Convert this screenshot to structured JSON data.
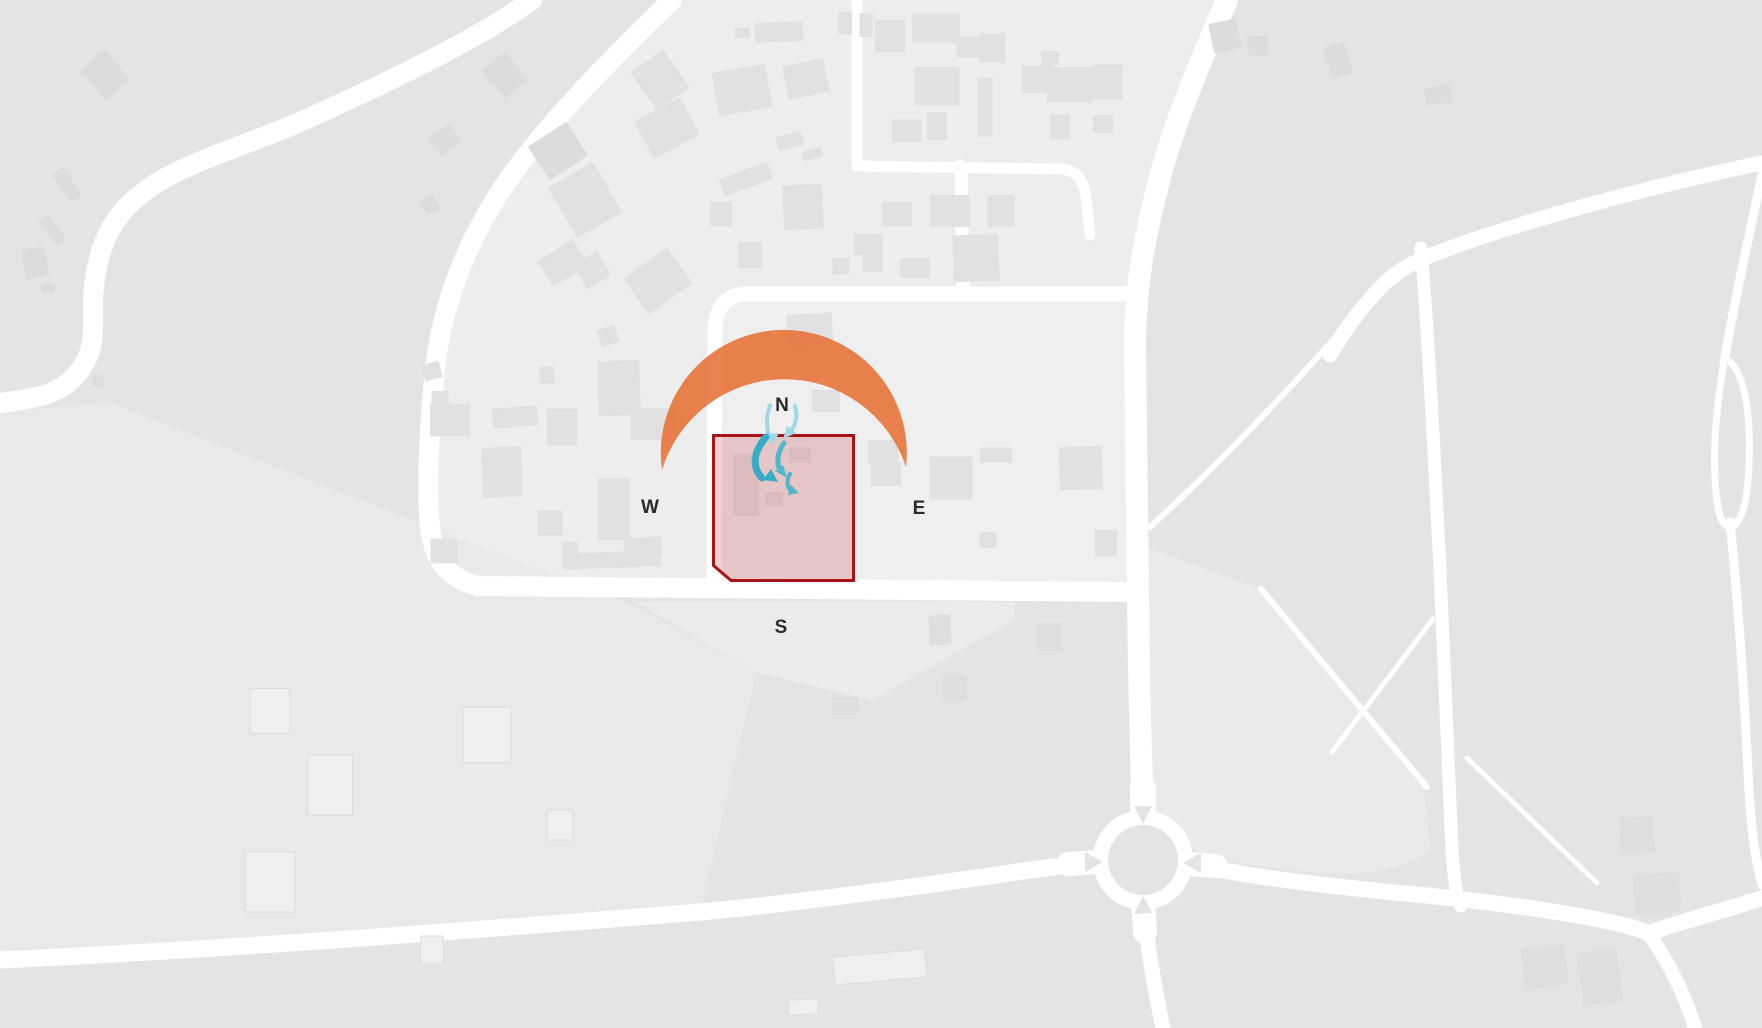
{
  "meta": {
    "view": "site-analysis-map",
    "canvas": {
      "w": 1762,
      "h": 1028
    }
  },
  "overlay": {
    "compass": {
      "n": "N",
      "w": "W",
      "e": "E",
      "s": "S"
    },
    "compass_positions": {
      "n": {
        "x": 782,
        "y": 411
      },
      "w": {
        "x": 650,
        "y": 513
      },
      "e": {
        "x": 919,
        "y": 514
      },
      "s": {
        "x": 781,
        "y": 633
      }
    },
    "compass_style": {
      "size": 19,
      "color": "#2a2a2a"
    },
    "site_boundary": {
      "points": "713.5,435.5 853.5,435.5 853.5,580.5 731,580.5 713.5,565.5",
      "fill": "rgba(205,100,100,0.30)",
      "stroke": "#a91313",
      "stroke_width": 3
    },
    "sun_path": {
      "path": "M 662,470 A 123,123 0 1 1 906,467 A 128,128 0 0 0 662,470 Z",
      "opacity": 0.92,
      "gradient": {
        "y1": 450,
        "y2": 618,
        "stops": [
          {
            "off": "0%",
            "color": "#e8763e"
          },
          {
            "off": "45%",
            "color": "#f0a55c"
          },
          {
            "off": "100%",
            "color": "#f8d977"
          }
        ]
      }
    },
    "wind_arrows": [
      {
        "path": "M 770,405 C 766,417 766,428 770,438",
        "w": 4,
        "color": "#9fd9e6",
        "head": "765,434 779,433 772,445"
      },
      {
        "path": "M 795,406 C 798,416 796,426 789,433",
        "w": 4,
        "color": "#9fd9e6",
        "head": "787,426 796,433 783,439"
      },
      {
        "path": "M 766,437 C 754,451 751,466 762,478",
        "w": 7,
        "color": "#38abc4",
        "head": "778,482 771,469 763,480"
      },
      {
        "path": "M 784,443 C 777,453 776,464 781,471",
        "w": 5,
        "color": "#4fb6cb",
        "head": "787,478 783,465 775,471"
      },
      {
        "path": "M 790,474 C 786,481 787,488 792,492",
        "w": 4,
        "color": "#4fb6cb",
        "head": "799,493 791,485 788,495"
      }
    ]
  },
  "map": {
    "colors": {
      "base": "#e4e4e4",
      "road": "#ffffff",
      "building_n": "#e1e1e1",
      "building_d": "#dcdcdc",
      "building_s": "#dedede",
      "building_e": "#dedede",
      "building_f": "#efefef",
      "building_f_stroke": "#dcdcdc",
      "island": "#e4e4e4"
    },
    "regions": [
      {
        "name": "district-upper",
        "fill": "#ededed",
        "d": "M 672,0 L 1227,0 C 1200,62 1172,128 1158,185 C 1144,240 1136,283 1135,340 L 1138,592 L 478,586 C 441,577 431,552 429,515 C 427,470 430,415 436,360 C 444,305 462,252 498,195 C 540,130 610,60 672,0 Z"
      },
      {
        "name": "inner-block",
        "fill": "#efefef",
        "d": "M 722,302 L 1128,302 L 1128,586 L 722,586 Z"
      },
      {
        "name": "parcel-south-triangle",
        "fill": "#ebebeb",
        "d": "M 636,602 L 1014,602 L 1014,620 L 872,700 L 754,672 Z"
      },
      {
        "name": "parcel-lower-left",
        "fill": "#e9e9e9",
        "d": "M 0,413 L 108,402 L 640,608 L 756,674 L 700,913 C 500,929 250,949 0,961 Z"
      },
      {
        "name": "field-east",
        "fill": "#eaeaea",
        "d": "M 1152,815 L 1148,548 L 1258,588 L 1424,786 L 1430,850 C 1380,888 1300,872 1205,858 Z"
      }
    ],
    "roads": [
      {
        "name": "rd-sw-curve",
        "w": 20,
        "d": "M 532,0 C 470,45 360,95 300,122 C 240,148 175,165 140,195 C 105,222 95,260 93,300 L 93,330 C 93,360 75,385 45,395 C 25,400 10,402 0,403"
      },
      {
        "name": "rd-arc-and-south",
        "w": 20,
        "d": "M 672,0 C 610,60 540,130 498,195 C 462,252 444,305 436,360 C 430,415 427,470 429,515 C 431,552 441,577 478,586 L 1132,592"
      },
      {
        "name": "rd-east-curve",
        "w": 22,
        "d": "M 1227,0 C 1200,62 1172,128 1158,185 C 1144,240 1136,283 1135,340 L 1138,600 C 1139,680 1141,760 1143,818"
      },
      {
        "name": "rd-ne-diagonal",
        "w": 15,
        "d": "M 1762,163 C 1650,186 1520,222 1442,251 C 1415,261 1398,270 1383,285 C 1360,308 1345,330 1330,355"
      },
      {
        "name": "rd-ne-branch",
        "w": 13,
        "d": "M 1421,248 C 1428,330 1434,450 1440,570 C 1444,660 1448,760 1452,850 C 1454,878 1456,895 1461,906"
      },
      {
        "name": "rd-bottom-left",
        "w": 17,
        "d": "M 0,960 C 250,948 500,928 700,912 C 800,903 950,882 1030,870 C 1060,866 1082,863 1096,862"
      },
      {
        "name": "rd-rb-east",
        "w": 16,
        "d": "M 1190,864 C 1246,876 1310,884 1400,893 C 1490,901 1615,918 1648,933 C 1700,916 1740,906 1762,898"
      },
      {
        "name": "rd-se-branch",
        "w": 14,
        "d": "M 1648,933 C 1668,960 1685,995 1695,1028"
      },
      {
        "name": "rd-rb-south",
        "w": 15,
        "d": "M 1143,902 C 1147,945 1155,990 1163,1028"
      },
      {
        "name": "rd-inner-loop",
        "w": 15,
        "d": "M 1128,294 L 748,294 C 726,295 716,306 715,330 L 714,588"
      },
      {
        "name": "rd-inner-vertical",
        "w": 13,
        "d": "M 963,295 L 961,166"
      },
      {
        "name": "rd-north-tee",
        "w": 11,
        "d": "M 857,0 L 857,162 M 857,166 L 1062,169 C 1077,171 1083,180 1086,196 L 1090,235"
      },
      {
        "name": "rd-right-lens",
        "w": 7,
        "d": "M 1724,362 C 1714,420 1712,470 1718,508 C 1723,532 1735,534 1743,510 C 1750,488 1752,430 1745,395 C 1740,372 1730,356 1724,362"
      },
      {
        "name": "rd-right-stem",
        "w": 9,
        "d": "M 1730,522 C 1738,600 1744,690 1748,770 C 1750,820 1755,860 1762,885"
      },
      {
        "name": "rd-right-top",
        "w": 9,
        "d": "M 1762,175 C 1748,240 1735,300 1724,362"
      },
      {
        "name": "footpath-1",
        "w": 6,
        "d": "M 1378,288 C 1330,345 1245,440 1150,527"
      },
      {
        "name": "footpath-2",
        "w": 6,
        "d": "M 1261,589 L 1427,787"
      },
      {
        "name": "footpath-3",
        "w": 5,
        "d": "M 1433,619 L 1332,752"
      },
      {
        "name": "footpath-4",
        "w": 5,
        "d": "M 1467,758 L 1597,883"
      },
      {
        "name": "rb-stub-n",
        "w": 26,
        "d": "M 1143,822 L 1143,788"
      },
      {
        "name": "rb-stub-w",
        "w": 24,
        "d": "M 1098,862 L 1068,864"
      },
      {
        "name": "rb-stub-s",
        "w": 24,
        "d": "M 1143,898 L 1145,932"
      },
      {
        "name": "rb-stub-e",
        "w": 24,
        "d": "M 1188,864 L 1216,866"
      }
    ],
    "roundabout": {
      "cx": 1143,
      "cy": 860,
      "r_outer": 50,
      "r_island": 35,
      "splitters": [
        "1134,806 1152,806 1143,824",
        "1085,852 1085,872 1103,862",
        "1134,914 1152,913 1143,896",
        "1201,853 1201,873 1183,863"
      ]
    },
    "buildings": [
      [
        105,
        75,
        32,
        40,
        -40,
        "d"
      ],
      [
        67,
        185,
        14,
        34,
        -35,
        "d"
      ],
      [
        52,
        230,
        12,
        30,
        -38,
        "d"
      ],
      [
        35,
        263,
        24,
        30,
        -10,
        "d"
      ],
      [
        48,
        289,
        12,
        9,
        0,
        "d"
      ],
      [
        98,
        381,
        11,
        12,
        0,
        "d"
      ],
      [
        445,
        140,
        26,
        22,
        -35,
        "d"
      ],
      [
        430,
        205,
        15,
        17,
        -30,
        "d"
      ],
      [
        505,
        75,
        30,
        36,
        -40,
        "d"
      ],
      [
        558,
        151,
        46,
        40,
        -33,
        "d"
      ],
      [
        1225,
        36,
        28,
        30,
        -12,
        "d"
      ],
      [
        1258,
        46,
        20,
        20,
        -5,
        "d"
      ],
      [
        1338,
        60,
        22,
        32,
        -18,
        "d"
      ],
      [
        1438,
        95,
        26,
        18,
        -8,
        "d"
      ],
      [
        585,
        200,
        52,
        58,
        -30,
        "n"
      ],
      [
        563,
        263,
        42,
        30,
        -32,
        "n"
      ],
      [
        592,
        270,
        28,
        28,
        -30,
        "n"
      ],
      [
        658,
        281,
        54,
        44,
        -35,
        "n"
      ],
      [
        660,
        80,
        40,
        46,
        -35,
        "n"
      ],
      [
        667,
        128,
        52,
        42,
        -28,
        "n"
      ],
      [
        742,
        90,
        54,
        44,
        -10,
        "n"
      ],
      [
        806,
        79,
        42,
        34,
        -12,
        "n"
      ],
      [
        890,
        36,
        30,
        33,
        0,
        "n"
      ],
      [
        845,
        23,
        14,
        23,
        0,
        "n"
      ],
      [
        866,
        25,
        13,
        24,
        0,
        "n"
      ],
      [
        742,
        33,
        15,
        10,
        0,
        "n"
      ],
      [
        779,
        32,
        48,
        20,
        -3,
        "n"
      ],
      [
        721,
        214,
        22,
        25,
        0,
        "n"
      ],
      [
        746,
        179,
        52,
        18,
        -20,
        "n"
      ],
      [
        803,
        207,
        40,
        45,
        -3,
        "n"
      ],
      [
        790,
        141,
        26,
        14,
        -15,
        "n"
      ],
      [
        812,
        154,
        20,
        10,
        -15,
        "n"
      ],
      [
        750,
        255,
        24,
        26,
        0,
        "n"
      ],
      [
        810,
        330,
        45,
        33,
        -3,
        "n"
      ],
      [
        826,
        401,
        28,
        22,
        0,
        "n"
      ],
      [
        883,
        452,
        30,
        24,
        0,
        "n"
      ],
      [
        886,
        474,
        30,
        24,
        0,
        "n"
      ],
      [
        951,
        478,
        43,
        43,
        0,
        "n"
      ],
      [
        996,
        455,
        32,
        15,
        0,
        "n"
      ],
      [
        1081,
        468,
        43,
        43,
        -2,
        "n"
      ],
      [
        1106,
        543,
        22,
        27,
        0,
        "n"
      ],
      [
        988,
        540,
        17,
        16,
        0,
        "n"
      ],
      [
        976,
        258,
        46,
        47,
        -2,
        "n"
      ],
      [
        873,
        253,
        20,
        38,
        0,
        "n"
      ],
      [
        841,
        266,
        17,
        17,
        0,
        "n"
      ],
      [
        915,
        268,
        30,
        20,
        0,
        "n"
      ],
      [
        897,
        214,
        30,
        25,
        0,
        "n"
      ],
      [
        950,
        211,
        40,
        32,
        0,
        "n"
      ],
      [
        1001,
        211,
        27,
        32,
        0,
        "n"
      ],
      [
        936,
        28,
        48,
        30,
        0,
        "n"
      ],
      [
        968,
        47,
        23,
        21,
        0,
        "n"
      ],
      [
        992,
        48,
        26,
        30,
        0,
        "n"
      ],
      [
        937,
        86,
        45,
        38,
        0,
        "n"
      ],
      [
        907,
        131,
        30,
        23,
        0,
        "n"
      ],
      [
        937,
        126,
        20,
        28,
        0,
        "n"
      ],
      [
        985,
        107,
        15,
        59,
        0,
        "n"
      ],
      [
        1037,
        79,
        31,
        28,
        0,
        "n"
      ],
      [
        1070,
        85,
        46,
        36,
        0,
        "n"
      ],
      [
        1107,
        82,
        31,
        35,
        0,
        "n"
      ],
      [
        1060,
        127,
        20,
        25,
        0,
        "n"
      ],
      [
        1103,
        124,
        20,
        18,
        0,
        "n"
      ],
      [
        1050,
        58,
        18,
        14,
        0,
        "n"
      ],
      [
        619,
        388,
        42,
        55,
        -2,
        "n"
      ],
      [
        654,
        424,
        47,
        32,
        0,
        "n"
      ],
      [
        515,
        417,
        45,
        20,
        -5,
        "n"
      ],
      [
        450,
        420,
        40,
        33,
        0,
        "n"
      ],
      [
        440,
        398,
        17,
        14,
        0,
        "n"
      ],
      [
        502,
        472,
        40,
        50,
        -2,
        "n"
      ],
      [
        550,
        523,
        26,
        25,
        0,
        "n"
      ],
      [
        614,
        509,
        32,
        62,
        0,
        "n"
      ],
      [
        444,
        551,
        27,
        25,
        0,
        "n"
      ],
      [
        570,
        554,
        16,
        25,
        0,
        "n"
      ],
      [
        612,
        560,
        97,
        16,
        -2,
        "n"
      ],
      [
        643,
        547,
        38,
        20,
        -2,
        "n"
      ],
      [
        562,
        427,
        30,
        37,
        0,
        "n"
      ],
      [
        547,
        375,
        15,
        17,
        0,
        "n"
      ],
      [
        608,
        336,
        19,
        18,
        -20,
        "n"
      ],
      [
        432,
        371,
        18,
        17,
        -15,
        "n"
      ],
      [
        863,
        244,
        18,
        22,
        0,
        "n"
      ],
      [
        746,
        485,
        26,
        62,
        0,
        "n"
      ],
      [
        774,
        499,
        18,
        14,
        0,
        "n"
      ],
      [
        800,
        455,
        22,
        15,
        0,
        "n"
      ],
      [
        940,
        630,
        22,
        30,
        -3,
        "s"
      ],
      [
        955,
        688,
        24,
        26,
        0,
        "s"
      ],
      [
        845,
        706,
        26,
        18,
        0,
        "s"
      ],
      [
        1050,
        637,
        24,
        28,
        0,
        "s"
      ],
      [
        270,
        711,
        40,
        45,
        0,
        "f"
      ],
      [
        330,
        785,
        45,
        60,
        0,
        "f"
      ],
      [
        487,
        735,
        48,
        55,
        0,
        "f"
      ],
      [
        270,
        882,
        50,
        60,
        0,
        "f"
      ],
      [
        560,
        825,
        26,
        30,
        0,
        "f"
      ],
      [
        432,
        950,
        22,
        28,
        0,
        "f"
      ],
      [
        880,
        967,
        92,
        28,
        -5,
        "f"
      ],
      [
        803,
        1007,
        30,
        15,
        -3,
        "f"
      ],
      [
        1637,
        835,
        34,
        36,
        -3,
        "e"
      ],
      [
        1657,
        893,
        46,
        40,
        -3,
        "e"
      ],
      [
        1545,
        967,
        44,
        40,
        -8,
        "e"
      ],
      [
        1600,
        977,
        40,
        53,
        -8,
        "e"
      ]
    ]
  }
}
